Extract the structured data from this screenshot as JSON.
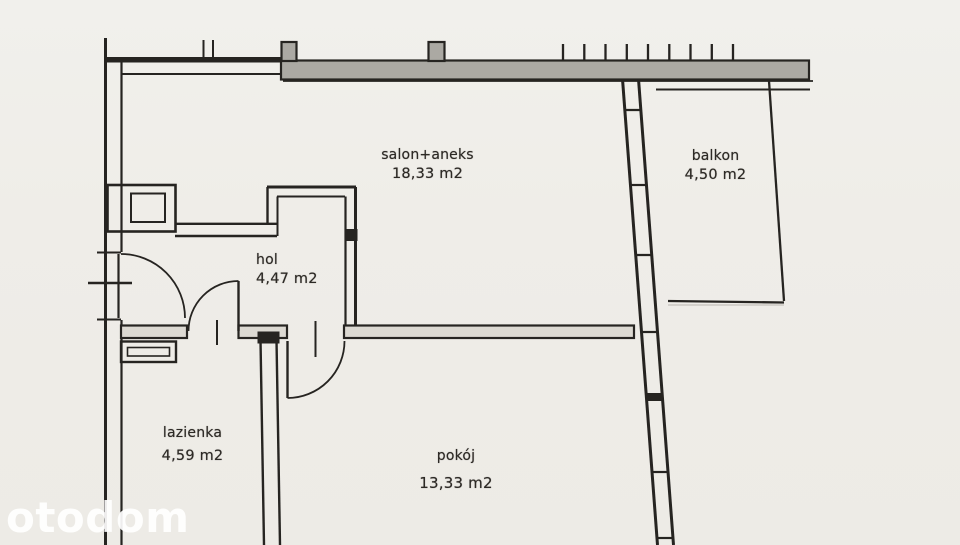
{
  "app": {
    "watermark": "otodom"
  },
  "floorplan": {
    "rooms": [
      {
        "id": "salon",
        "name": "salon+aneks",
        "area": "18,33 m2"
      },
      {
        "id": "balkon",
        "name": "balkon",
        "area": "4,50 m2"
      },
      {
        "id": "hol",
        "name": "hol",
        "area": "4,47 m2"
      },
      {
        "id": "lazienka",
        "name": "lazienka",
        "area": "4,59 m2"
      },
      {
        "id": "pokoj",
        "name": "pokój",
        "area": "13,33 m2"
      }
    ],
    "colors": {
      "paper": "#efede8",
      "line": "#262421",
      "wall_fill": "#aba9a3",
      "label": "#2c2925",
      "watermark": "#ffffff"
    }
  }
}
